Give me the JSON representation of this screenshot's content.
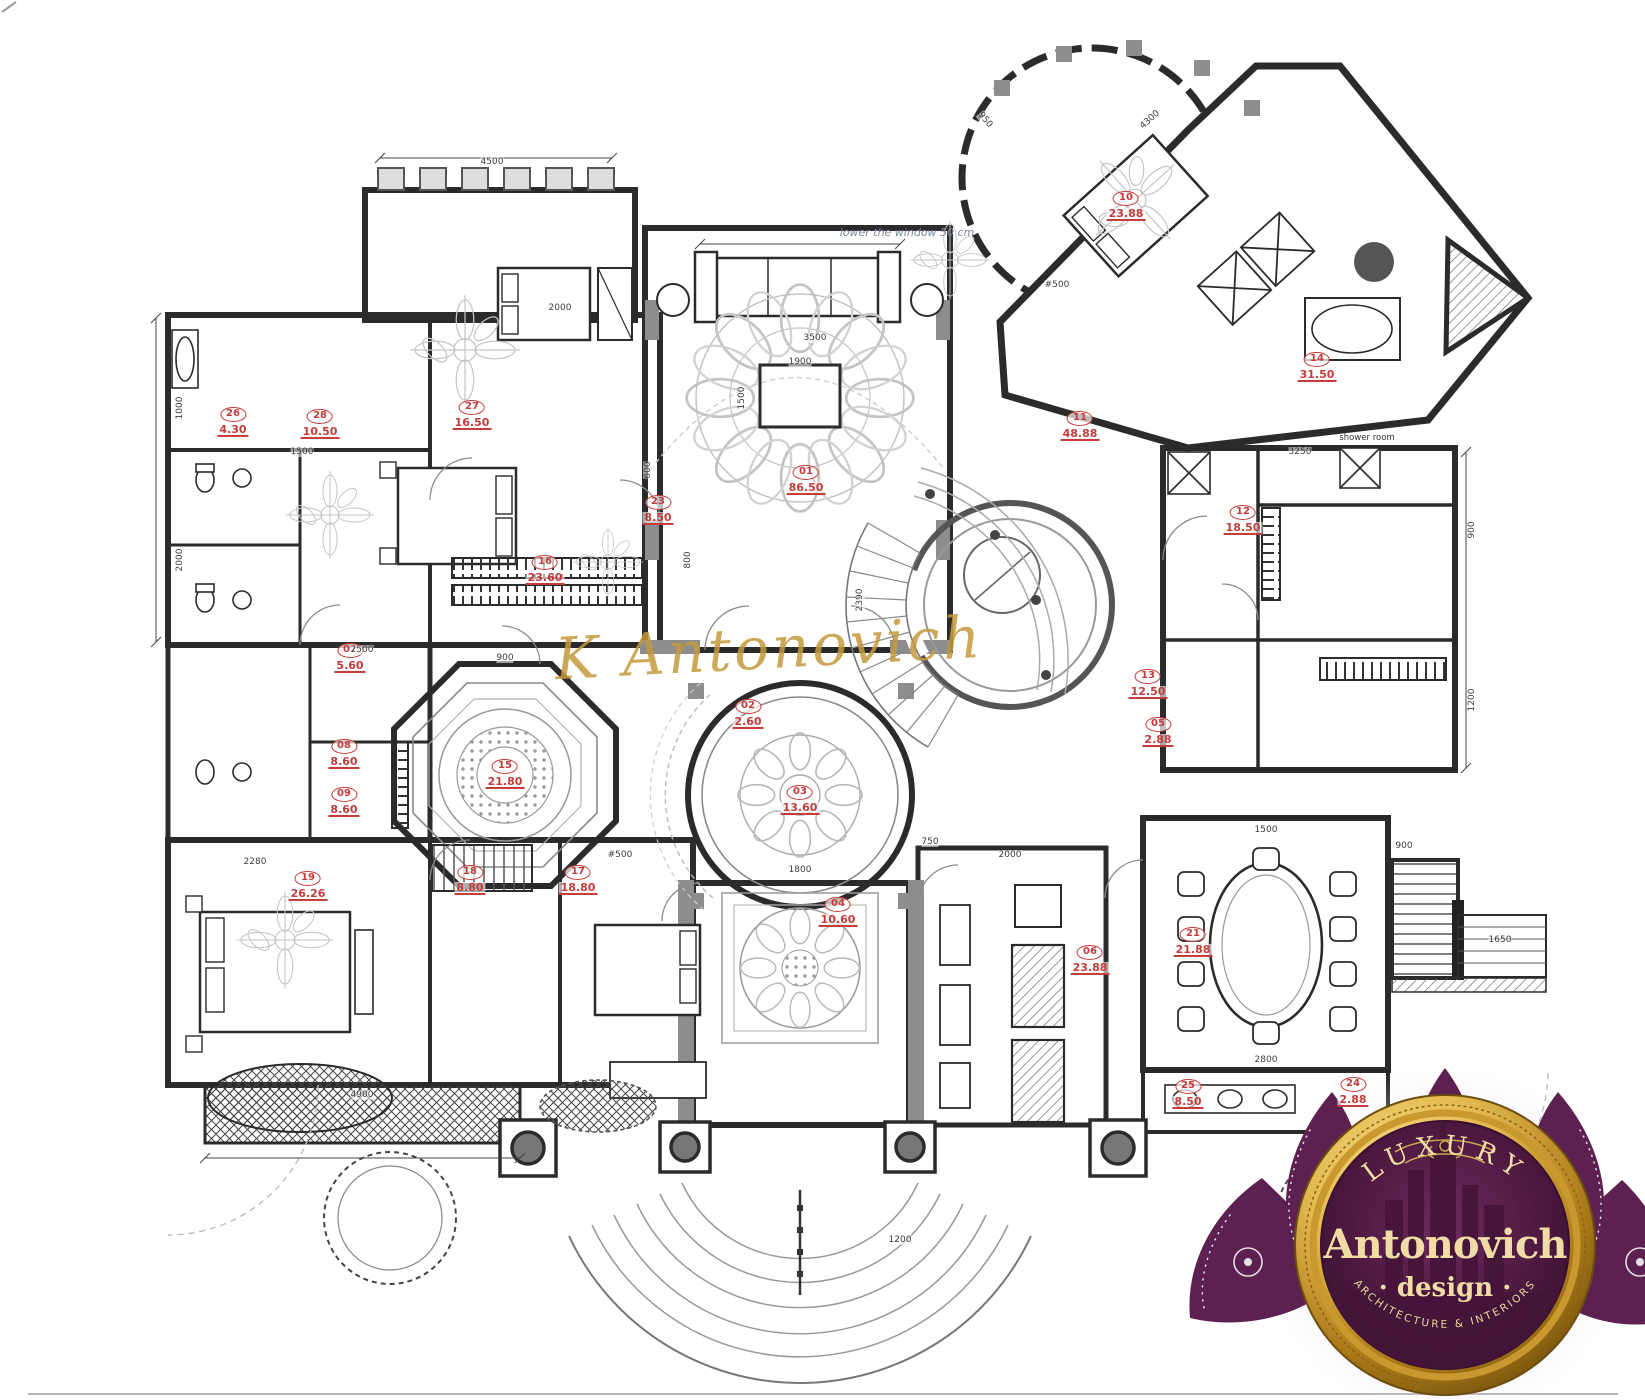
{
  "watermark": {
    "text": "K Antonovich",
    "color": "#c49a3c"
  },
  "note": {
    "text": "lower the window 50 cm"
  },
  "annotations": {
    "shower_room": "shower room"
  },
  "logo": {
    "top": "LUXURY",
    "name": "Antonovich",
    "sub": "· design ·",
    "tagline": "ARCHITECTURE & INTERIORS",
    "petal_color": "#5c2150",
    "gold": "#e7c25c",
    "cream": "#f3dfae"
  },
  "colors": {
    "wall": "#2b2b2b",
    "red_label": "#c43b3b",
    "dim_text": "#3c3c3c"
  },
  "plan": {
    "rooms": [
      {
        "id": "26",
        "area": "4.30",
        "x": 233,
        "y": 420
      },
      {
        "id": "28",
        "area": "10.50",
        "x": 320,
        "y": 422
      },
      {
        "id": "27",
        "area": "16.50",
        "x": 472,
        "y": 413
      },
      {
        "id": "23",
        "area": "8.50",
        "x": 658,
        "y": 508
      },
      {
        "id": "01",
        "area": "86.50",
        "x": 806,
        "y": 478
      },
      {
        "id": "16",
        "area": "23.60",
        "x": 545,
        "y": 568
      },
      {
        "id": "07",
        "area": "5.60",
        "x": 350,
        "y": 656
      },
      {
        "id": "08",
        "area": "8.60",
        "x": 344,
        "y": 752
      },
      {
        "id": "09",
        "area": "8.60",
        "x": 344,
        "y": 800
      },
      {
        "id": "15",
        "area": "21.80",
        "x": 505,
        "y": 772
      },
      {
        "id": "02",
        "area": "2.60",
        "x": 748,
        "y": 712
      },
      {
        "id": "03",
        "area": "13.60",
        "x": 800,
        "y": 798
      },
      {
        "id": "06",
        "area": "23.88",
        "x": 1090,
        "y": 958
      },
      {
        "id": "05",
        "area": "2.88",
        "x": 1158,
        "y": 730
      },
      {
        "id": "13",
        "area": "12.50",
        "x": 1148,
        "y": 682
      },
      {
        "id": "11",
        "area": "48.88",
        "x": 1080,
        "y": 424
      },
      {
        "id": "12",
        "area": "18.50",
        "x": 1243,
        "y": 518
      },
      {
        "id": "10",
        "area": "23.88",
        "x": 1126,
        "y": 204
      },
      {
        "id": "14",
        "area": "31.50",
        "x": 1317,
        "y": 365
      },
      {
        "id": "19",
        "area": "26.26",
        "x": 308,
        "y": 884
      },
      {
        "id": "18",
        "area": "8.80",
        "x": 470,
        "y": 878
      },
      {
        "id": "17",
        "area": "18.80",
        "x": 578,
        "y": 878
      },
      {
        "id": "04",
        "area": "10.60",
        "x": 838,
        "y": 910
      },
      {
        "id": "21",
        "area": "21.88",
        "x": 1193,
        "y": 940
      },
      {
        "id": "25",
        "area": "8.50",
        "x": 1188,
        "y": 1092
      },
      {
        "id": "24",
        "area": "2.88",
        "x": 1353,
        "y": 1090
      }
    ],
    "dims": [
      {
        "v": "4500",
        "x": 492,
        "y": 162
      },
      {
        "v": "2000",
        "x": 560,
        "y": 308
      },
      {
        "v": "3500",
        "x": 815,
        "y": 338
      },
      {
        "v": "1900",
        "x": 800,
        "y": 362
      },
      {
        "v": "1500",
        "x": 742,
        "y": 398,
        "r": -90
      },
      {
        "v": "#500",
        "x": 1057,
        "y": 285
      },
      {
        "v": "1000",
        "x": 180,
        "y": 408,
        "r": -90
      },
      {
        "v": "2000",
        "x": 180,
        "y": 560,
        "r": -90
      },
      {
        "v": "1500",
        "x": 302,
        "y": 452
      },
      {
        "v": "2500",
        "x": 362,
        "y": 650
      },
      {
        "v": "900",
        "x": 505,
        "y": 658
      },
      {
        "v": "800",
        "x": 688,
        "y": 560,
        "r": -90
      },
      {
        "v": "600",
        "x": 648,
        "y": 470,
        "r": -90
      },
      {
        "v": "4900",
        "x": 362,
        "y": 1095
      },
      {
        "v": "2280",
        "x": 255,
        "y": 862
      },
      {
        "v": "1800",
        "x": 800,
        "y": 870
      },
      {
        "v": "#500",
        "x": 620,
        "y": 855
      },
      {
        "v": "3250",
        "x": 1300,
        "y": 452
      },
      {
        "v": "900",
        "x": 1472,
        "y": 530,
        "r": -90
      },
      {
        "v": "1200",
        "x": 1472,
        "y": 700,
        "r": -90
      },
      {
        "v": "1500",
        "x": 1266,
        "y": 830
      },
      {
        "v": "2800",
        "x": 1266,
        "y": 1060
      },
      {
        "v": "900",
        "x": 1404,
        "y": 846
      },
      {
        "v": "1650",
        "x": 1500,
        "y": 940
      },
      {
        "v": "750",
        "x": 930,
        "y": 842
      },
      {
        "v": "2000",
        "x": 1010,
        "y": 855
      },
      {
        "v": "1200",
        "x": 900,
        "y": 1240
      },
      {
        "v": "4300",
        "x": 1150,
        "y": 120,
        "r": -42
      },
      {
        "v": "2390",
        "x": 860,
        "y": 600,
        "r": -90
      },
      {
        "v": "950",
        "x": 985,
        "y": 120,
        "r": 50
      }
    ]
  }
}
